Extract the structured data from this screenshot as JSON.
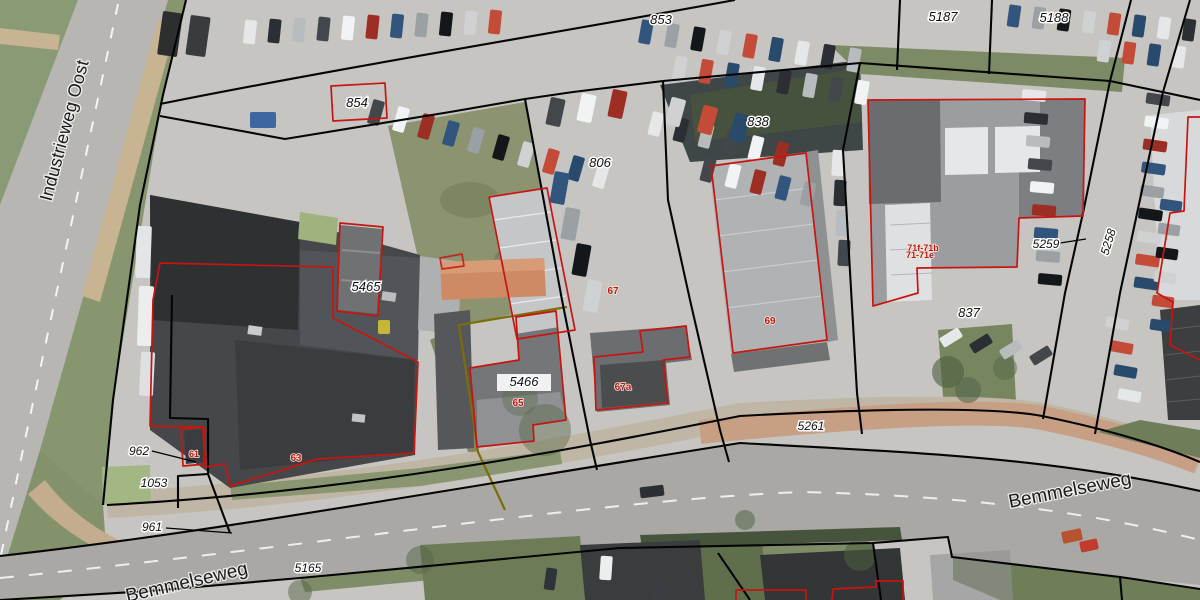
{
  "app": {
    "name": "cadastral-aerial-map-view"
  },
  "colors": {
    "parcel_line": "#000000",
    "building_outline": "#c8150f",
    "selected_parcel_outline": "#7a6d0a",
    "parcel_label_text": "#111111",
    "house_number_text": "#c01810",
    "street_label_text": "#1c1c1c",
    "label_halo": "#ffffff"
  },
  "streets": [
    {
      "id": "industrieweg-oost",
      "text": "Industrieweg Oost",
      "x": 70,
      "y": 132,
      "rotation": -75,
      "size": 18
    },
    {
      "id": "bemmelseweg-east",
      "text": "Bemmelseweg",
      "x": 1071,
      "y": 496,
      "rotation": -11,
      "size": 19
    },
    {
      "id": "bemmelseweg-south",
      "text": "Bemmelseweg",
      "x": 188,
      "y": 588,
      "rotation": -13,
      "size": 19
    }
  ],
  "parcels": [
    {
      "text": "853",
      "x": 661,
      "y": 24,
      "size": 13
    },
    {
      "text": "854",
      "x": 357,
      "y": 107,
      "size": 13
    },
    {
      "text": "5187",
      "x": 943,
      "y": 21,
      "size": 13
    },
    {
      "text": "5188",
      "x": 1054,
      "y": 22,
      "size": 13
    },
    {
      "text": "806",
      "x": 600,
      "y": 167,
      "size": 13
    },
    {
      "text": "838",
      "x": 758,
      "y": 126,
      "size": 13
    },
    {
      "text": "5465",
      "x": 366,
      "y": 291,
      "size": 13
    },
    {
      "text": "5466",
      "x": 524,
      "y": 386,
      "size": 13,
      "halo_box": true
    },
    {
      "text": "837",
      "x": 969,
      "y": 317,
      "size": 13
    },
    {
      "text": "5261",
      "x": 811,
      "y": 430,
      "size": 12
    },
    {
      "text": "962",
      "x": 139,
      "y": 455,
      "size": 12,
      "leader": [
        152,
        451,
        196,
        462
      ]
    },
    {
      "text": "1053",
      "x": 154,
      "y": 487,
      "size": 12
    },
    {
      "text": "961",
      "x": 152,
      "y": 531,
      "size": 12,
      "leader": [
        166,
        528,
        232,
        533
      ]
    },
    {
      "text": "5165",
      "x": 308,
      "y": 572,
      "size": 12
    },
    {
      "text": "5259",
      "x": 1046,
      "y": 248,
      "size": 12,
      "leader": [
        1060,
        243,
        1086,
        239
      ]
    },
    {
      "text": "5258",
      "x": 1112,
      "y": 243,
      "size": 12,
      "rotation": -73
    }
  ],
  "house_numbers": [
    {
      "text": "61",
      "x": 194,
      "y": 457,
      "size": 9
    },
    {
      "text": "63",
      "x": 296,
      "y": 461,
      "size": 10
    },
    {
      "text": "65",
      "x": 518,
      "y": 406,
      "size": 10
    },
    {
      "text": "67",
      "x": 613,
      "y": 294,
      "size": 10
    },
    {
      "text": "67a",
      "x": 623,
      "y": 390,
      "size": 10
    },
    {
      "text": "69",
      "x": 770,
      "y": 324,
      "size": 10
    },
    {
      "text": "71f-71b",
      "x": 923,
      "y": 251,
      "size": 9
    },
    {
      "text": "71-71e",
      "x": 920,
      "y": 258,
      "size": 9
    }
  ]
}
